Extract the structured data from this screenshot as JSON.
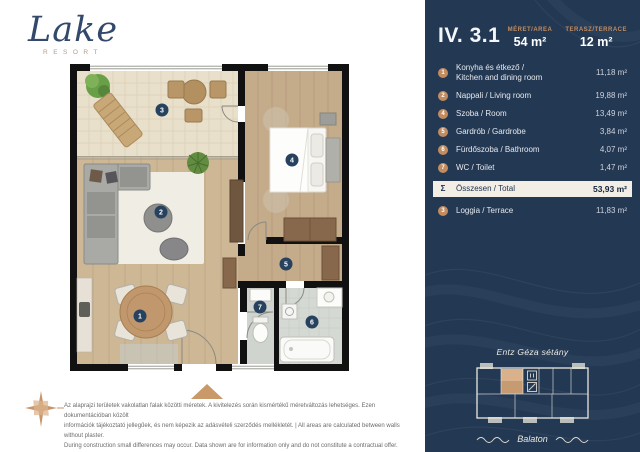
{
  "brand": {
    "name": "Lake",
    "subtitle": "RESORT"
  },
  "unit": {
    "id": "IV. 3.1",
    "area_label": "MÉRET/AREA",
    "area_value": "54 m²",
    "terrace_label": "TERASZ/TERRACE",
    "terrace_value": "12 m²"
  },
  "rooms": [
    {
      "num": "1",
      "name_hu": "Konyha és étkező /",
      "name_en": "Kitchen and dining room",
      "area": "11,18 m²"
    },
    {
      "num": "2",
      "name": "Nappali / Living room",
      "area": "19,88 m²"
    },
    {
      "num": "4",
      "name": "Szoba / Room",
      "area": "13,49 m²"
    },
    {
      "num": "5",
      "name": "Gardrób / Gardrobe",
      "area": "3,84 m²"
    },
    {
      "num": "6",
      "name": "Fürdőszoba / Bathroom",
      "area": "4,07 m²"
    },
    {
      "num": "7",
      "name": "WC / Toilet",
      "area": "1,47 m²"
    }
  ],
  "total": {
    "sign": "Σ",
    "label": "Összesen / Total",
    "area": "53,93 m²"
  },
  "loggia": {
    "num": "3",
    "label": "Loggia / Terrace",
    "area": "11,83 m²"
  },
  "site_map": {
    "street": "Entz Géza sétány",
    "lake": "Balaton"
  },
  "plan_markers": {
    "k1": "1",
    "k2": "2",
    "k3": "3",
    "k4": "4",
    "k5": "5",
    "k6": "6",
    "k7": "7"
  },
  "disclaimer": {
    "line1": "Az alaprajzi területek vakolatlan falak közötti méretek. A kivitelezés során kismértékű méretváltozás lehetséges. Ezen dokumentációban közölt",
    "line2": "információk tájékoztató jellegűek, és nem képezik az adásvételi szerződés mellékletét. | All areas are calculated between walls without plaster.",
    "line3": "During construction small differences may occur. Data shown are for information only and do not constitute a contractual offer."
  },
  "colors": {
    "panel_navy": "#233853",
    "accent_tan": "#c28c60",
    "total_row_bg": "#f2eee5",
    "logo_navy": "#33496b",
    "wall_black": "#111111",
    "wood_floor": "#cdb795",
    "terrace_tile": "#e9e0cb",
    "marker_navy": "#27425f"
  }
}
